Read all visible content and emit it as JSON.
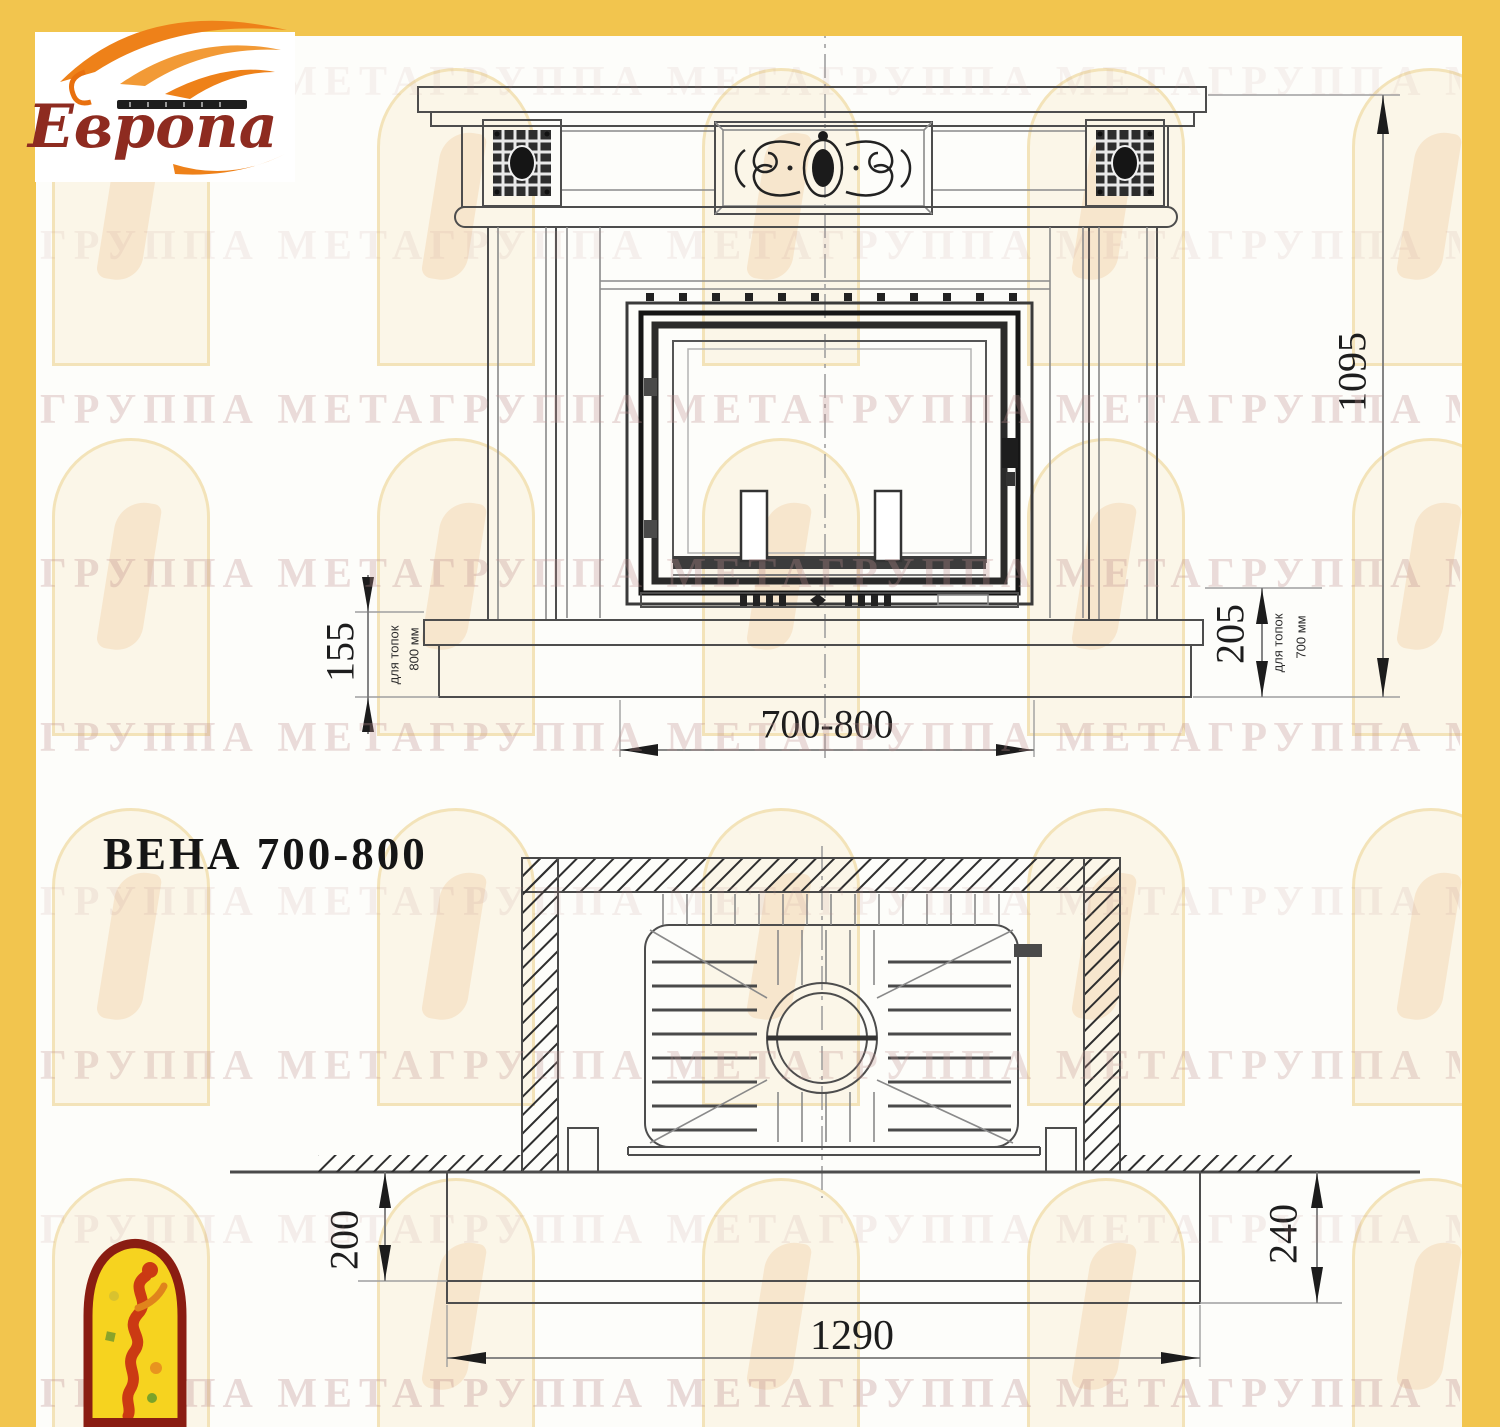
{
  "brand": {
    "name": "Европа"
  },
  "title": "ВЕНА 700-800",
  "front_view": {
    "total_height": "1095",
    "plinth_left": "155",
    "plinth_left_note1": "для топок",
    "plinth_left_note2": "800 мм",
    "plinth_right": "205",
    "plinth_right_note1": "для топок",
    "plinth_right_note2": "700 мм",
    "opening_width": "700-800"
  },
  "plan_view": {
    "hearth_depth_left": "200",
    "hearth_depth_right": "240",
    "hearth_width": "1290"
  },
  "watermark": {
    "row_text": "ГРУППА МЕТАГРУППА МЕТАГРУППА МЕТАГРУППА МЕТАГРУППА МЕТА"
  },
  "colors": {
    "page_border": "#f2c54e",
    "brand_text": "#8e2b20",
    "flame_orange": "#ee8119",
    "meta_logo_yellow": "#f6d31f",
    "meta_logo_red": "#8a1d12",
    "watermark_pink": "#bf8f8f",
    "line_gray": "#4d4d4d"
  }
}
